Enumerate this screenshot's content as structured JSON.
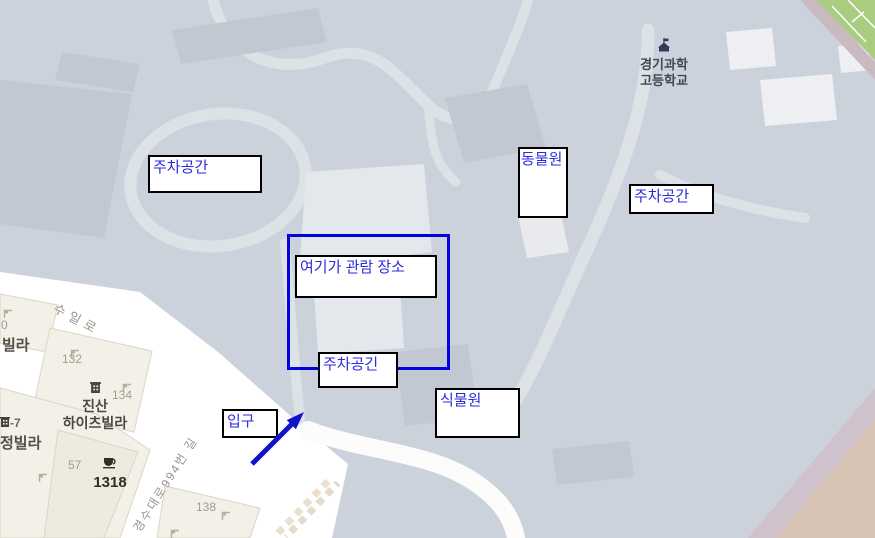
{
  "annotations": {
    "parking_left": "주차공간",
    "zoo": "동물원",
    "parking_right": "주차공간",
    "viewing": "여기가 관람 장소",
    "parking_center": "주차공긴",
    "botanical": "식물원",
    "entrance": "입구"
  },
  "map_labels": {
    "school_line1": "경기과학",
    "school_line2": "고등학교",
    "road_suillo": "수일로",
    "road_gyeongsu": "경수대로994번 길",
    "villa_partial": "빌라",
    "jung_villa_partial": "정빌라",
    "jinsan_line1": "진산",
    "jinsan_line2": "하이츠빌라",
    "num_0": "0",
    "num_132": "132",
    "num_134": "134",
    "num_57": "57",
    "num_138": "138",
    "num_1318": "1318",
    "num_suffix_7": "-7"
  },
  "colors": {
    "campus_base": "#CCD2DB",
    "building_dark": "#C1C8D2",
    "building_light": "#E4E7EB",
    "building_white": "#EDEFF2",
    "path_light": "#DDE2E7",
    "road_white": "#FFFFFF",
    "beige_building": "#F3F0E8",
    "beige_border": "#DBD5C7",
    "green_field": "#A9CC80",
    "track_pink": "#CBB9C1",
    "tan_area": "#D8C4B4",
    "mauve_strip": "#CFC2CC",
    "annotation_text_blue": "#2B2BDF",
    "annotation_rect_blue": "#0004DD",
    "arrow_blue": "#1212CC",
    "box_border": "#000000"
  }
}
